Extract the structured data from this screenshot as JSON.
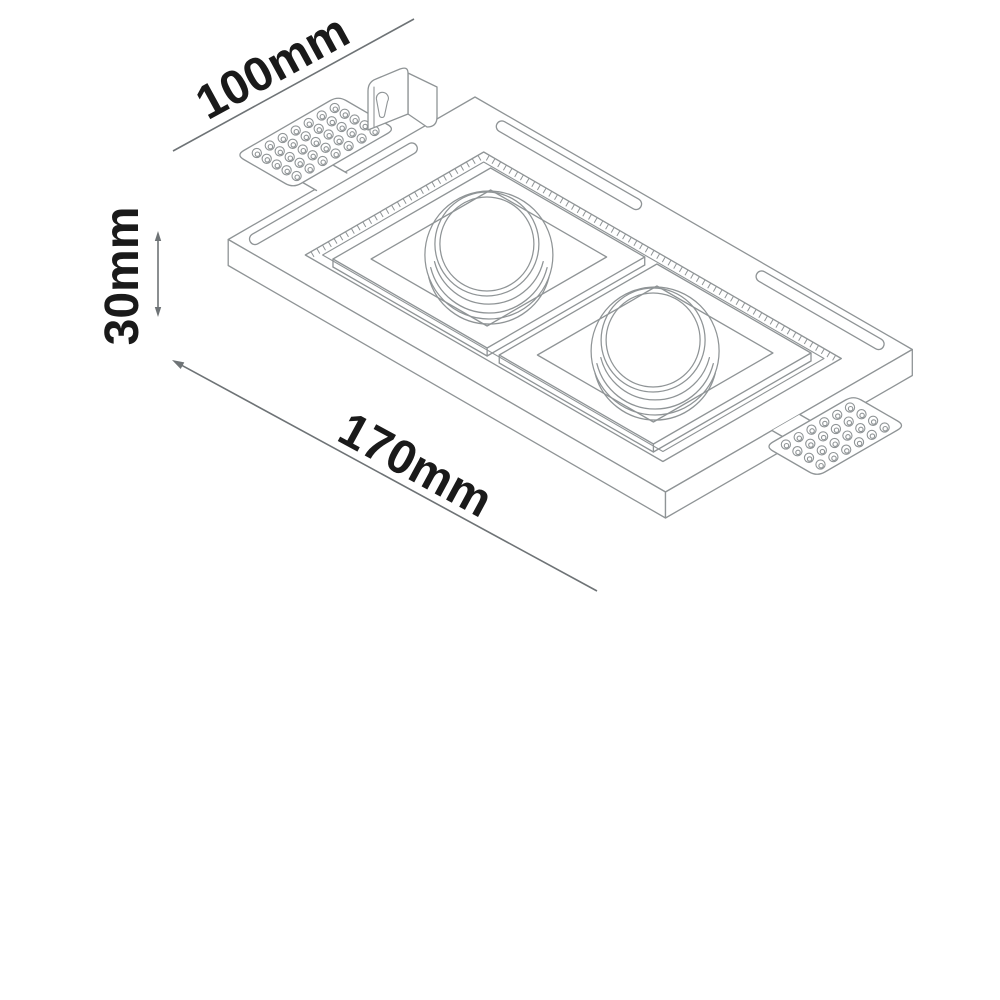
{
  "page": {
    "background": "#ffffff"
  },
  "colors": {
    "fixture_line": "#8f9496",
    "dimension_line": "#6e7376",
    "label_text": "#1a1a1a",
    "surface_fill": "#ffffff"
  },
  "dimensions": {
    "width": {
      "label": "100mm"
    },
    "depth": {
      "label": "30mm"
    },
    "length": {
      "label": "170mm"
    }
  },
  "fixture": {
    "lamp_count": 2,
    "perforated_tab_count": 2,
    "plaster_key_slot_count": 3
  }
}
